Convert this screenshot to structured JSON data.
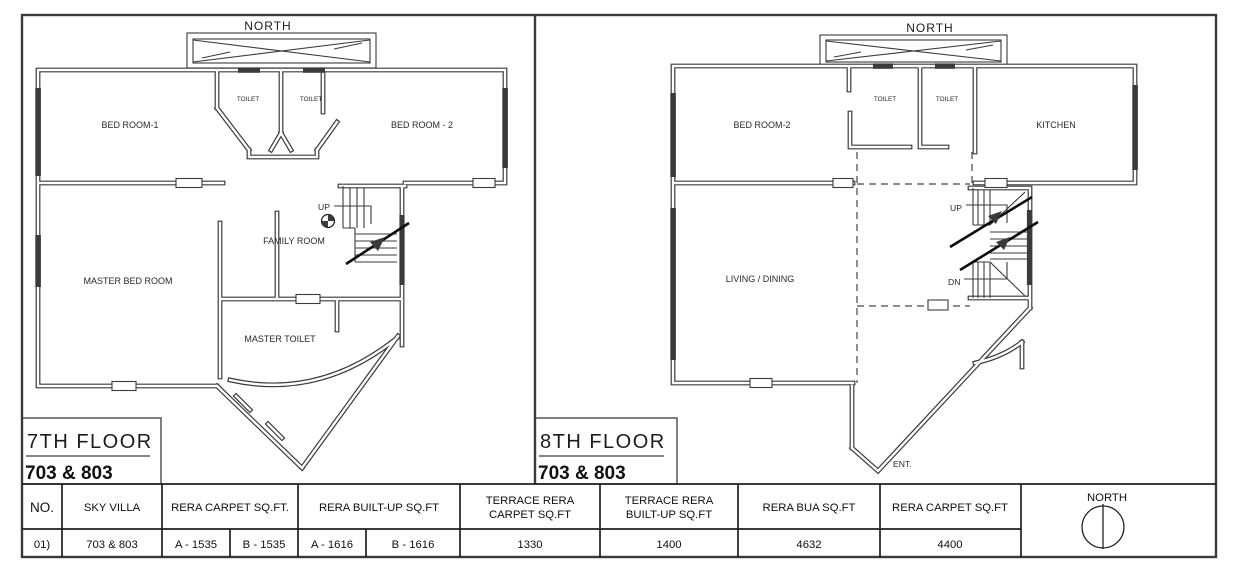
{
  "drawing": {
    "ink_color": "#3a3a3a",
    "background": "#ffffff"
  },
  "plan7": {
    "north": "NORTH",
    "bedroom1": "BED ROOM-1",
    "toilet_left": "TOILET",
    "toilet_right": "TOILET",
    "bedroom2": "BED ROOM - 2",
    "family_room": "FAMILY ROOM",
    "up": "UP",
    "master_bedroom": "MASTER BED ROOM",
    "master_toilet": "MASTER TOILET",
    "floor_title": "7TH FLOOR",
    "floor_units": "703 & 803"
  },
  "plan8": {
    "north": "NORTH",
    "bedroom2": "BED ROOM-2",
    "toilet_left": "TOILET",
    "toilet_right": "TOILET",
    "kitchen": "KITCHEN",
    "living_dining": "LIVING / DINING",
    "up": "UP",
    "dn": "DN",
    "entrance": "ENT.",
    "floor_title": "8TH FLOOR",
    "floor_units": "703 & 803"
  },
  "table": {
    "col_no": "NO.",
    "col_sky_villa": "SKY VILLA",
    "col_rera_carpet": "RERA CARPET SQ.FT.",
    "col_rera_builtup": "RERA BUILT-UP SQ.FT",
    "col_terrace_carpet_line1": "TERRACE RERA",
    "col_terrace_carpet_line2": "CARPET SQ.FT",
    "col_terrace_builtup_line1": "TERRACE RERA",
    "col_terrace_builtup_line2": "BUILT-UP SQ.FT",
    "col_rera_bua": "RERA BUA SQ.FT",
    "col_rera_carpet2": "RERA CARPET SQ.FT",
    "compass_north": "NORTH",
    "row": {
      "no": "01)",
      "sky_villa": "703 & 803",
      "rera_carpet_a": "A - 1535",
      "rera_carpet_b": "B - 1535",
      "rera_builtup_a": "A - 1616",
      "rera_builtup_b": "B - 1616",
      "terrace_carpet": "1330",
      "terrace_builtup": "1400",
      "rera_bua": "4632",
      "rera_carpet": "4400"
    }
  }
}
